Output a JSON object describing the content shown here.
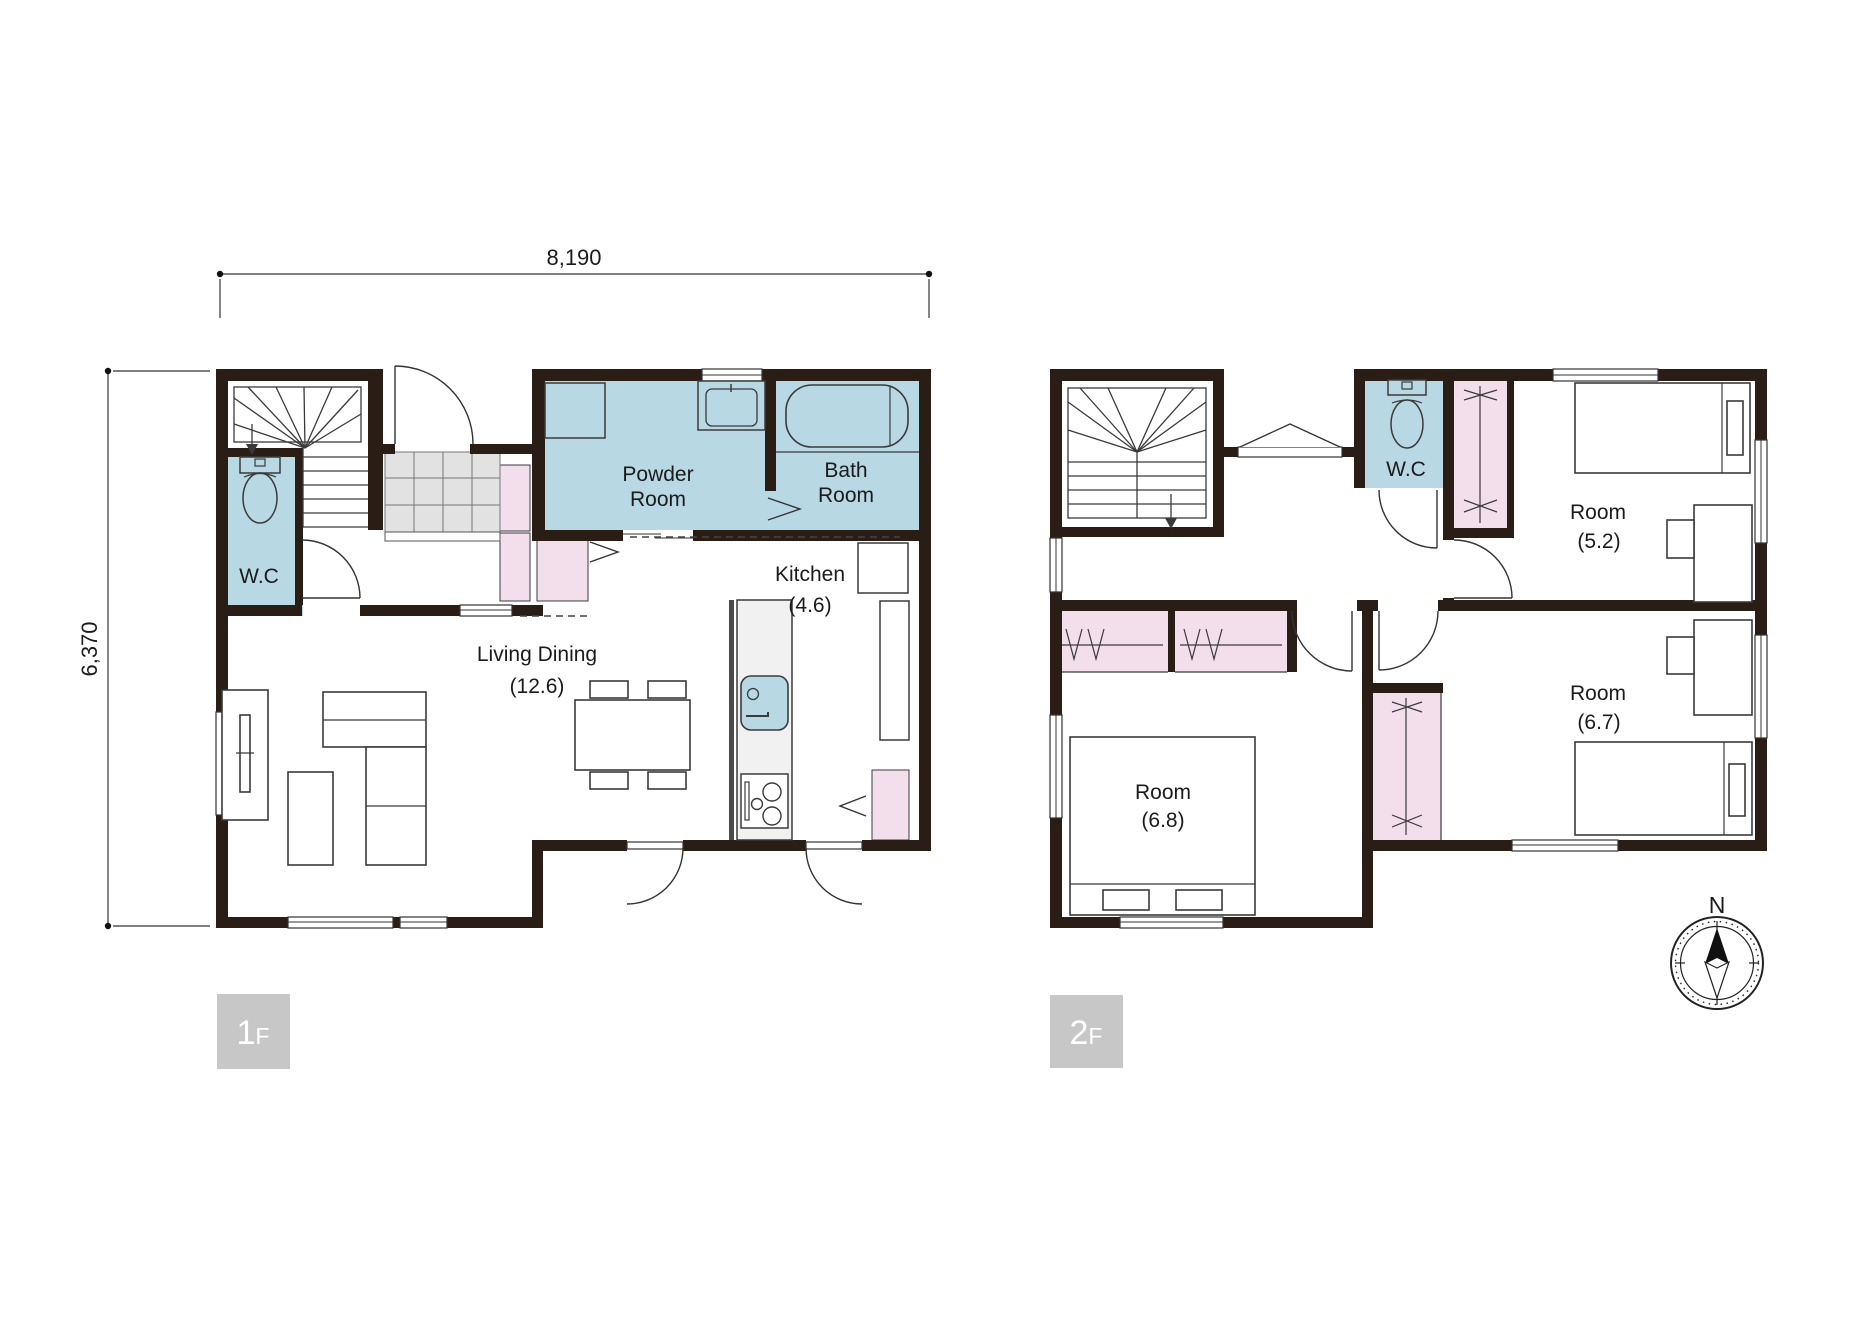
{
  "page": {
    "background": "#ffffff"
  },
  "colors": {
    "wall": "#2a1d15",
    "wet_area_blue": "#b8d8e4",
    "closet_pink": "#f3deec",
    "tile_gray": "#e2e2e2",
    "badge_gray": "#c7c7c7"
  },
  "dimensions": {
    "width": "8,190",
    "height": "6,370"
  },
  "floor1": {
    "badge_num": "1",
    "badge_suffix": "F",
    "wc": "W.C",
    "powder_line1": "Powder",
    "powder_line2": "Room",
    "bath_line1": "Bath",
    "bath_line2": "Room",
    "kitchen": "Kitchen",
    "kitchen_size": "(4.6)",
    "living": "Living Dining",
    "living_size": "(12.6)"
  },
  "floor2": {
    "badge_num": "2",
    "badge_suffix": "F",
    "wc": "W.C",
    "room52": "Room",
    "room52_size": "(5.2)",
    "room67": "Room",
    "room67_size": "(6.7)",
    "room68": "Room",
    "room68_size": "(6.8)"
  },
  "compass": {
    "north": "N"
  }
}
